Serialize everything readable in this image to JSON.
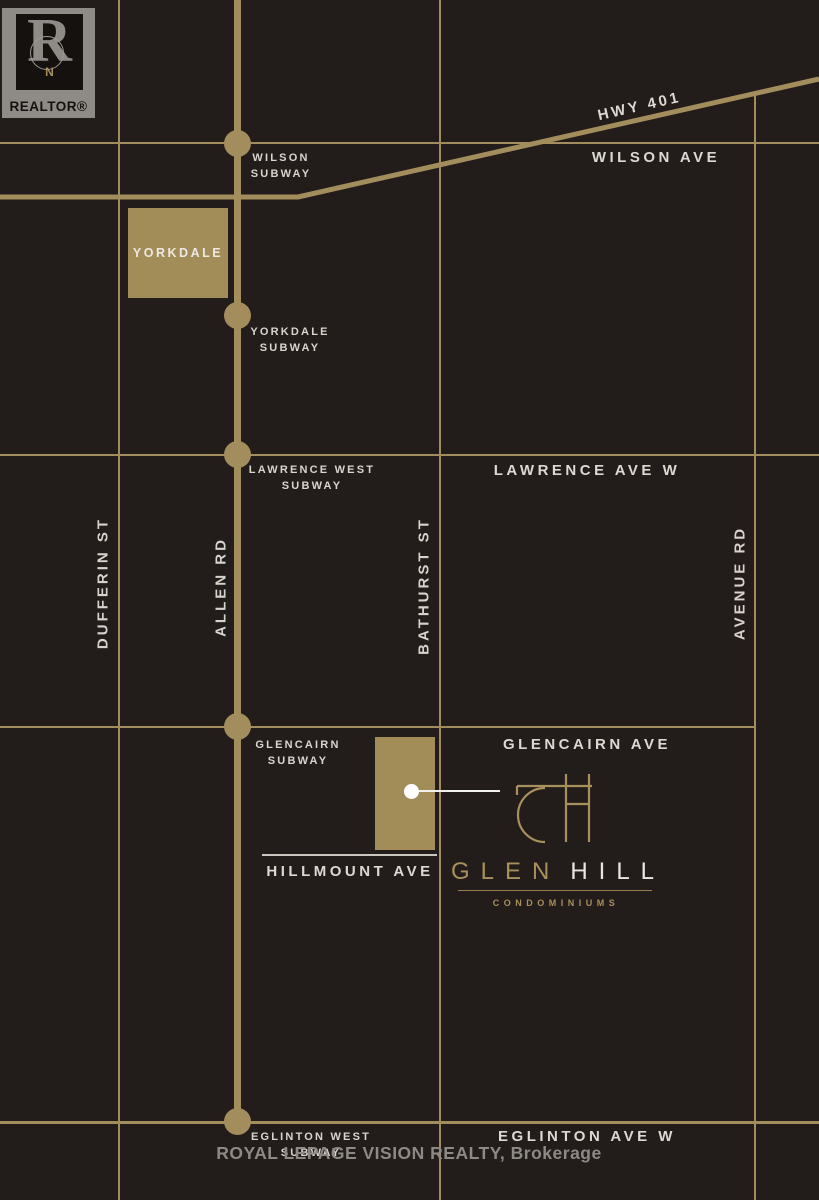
{
  "streets": {
    "hwy401": "HWY 401",
    "wilson_ave": "WILSON AVE",
    "lawrence_ave": "LAWRENCE AVE W",
    "glencairn_ave": "GLENCAIRN AVE",
    "eglinton_ave": "EGLINTON AVE W",
    "hillmount_ave": "HILLMOUNT AVE",
    "dufferin_st": "DUFFERIN ST",
    "allen_rd": "ALLEN RD",
    "bathurst_st": "BATHURST ST",
    "avenue_rd": "AVENUE RD"
  },
  "stations": {
    "wilson": {
      "l1": "WILSON",
      "l2": "SUBWAY"
    },
    "yorkdale": {
      "l1": "YORKDALE",
      "l2": "SUBWAY"
    },
    "lawrence_west": {
      "l1": "LAWRENCE WEST",
      "l2": "SUBWAY"
    },
    "glencairn": {
      "l1": "GLENCAIRN",
      "l2": "SUBWAY"
    },
    "eglinton_west": {
      "l1": "EGLINTON WEST",
      "l2": "SUBWAY"
    }
  },
  "landmark": {
    "yorkdale": "YORKDALE"
  },
  "branding": {
    "monogram": "GH",
    "glen": "GLEN",
    "hill": "HILL",
    "subtitle": "CONDOMINIUMS"
  },
  "realtor_badge": {
    "label": "REALTOR®",
    "letter": "R",
    "compass_n": "N"
  },
  "watermark": {
    "text": "ROYAL LEPAGE VISION REALTY, Brokerage"
  },
  "colors": {
    "background": "#221d1a",
    "gold": "#a38d5c",
    "white_text": "#dcd8d2",
    "watermark_gray": "#8d8984",
    "site_marker": "#ffffff"
  }
}
